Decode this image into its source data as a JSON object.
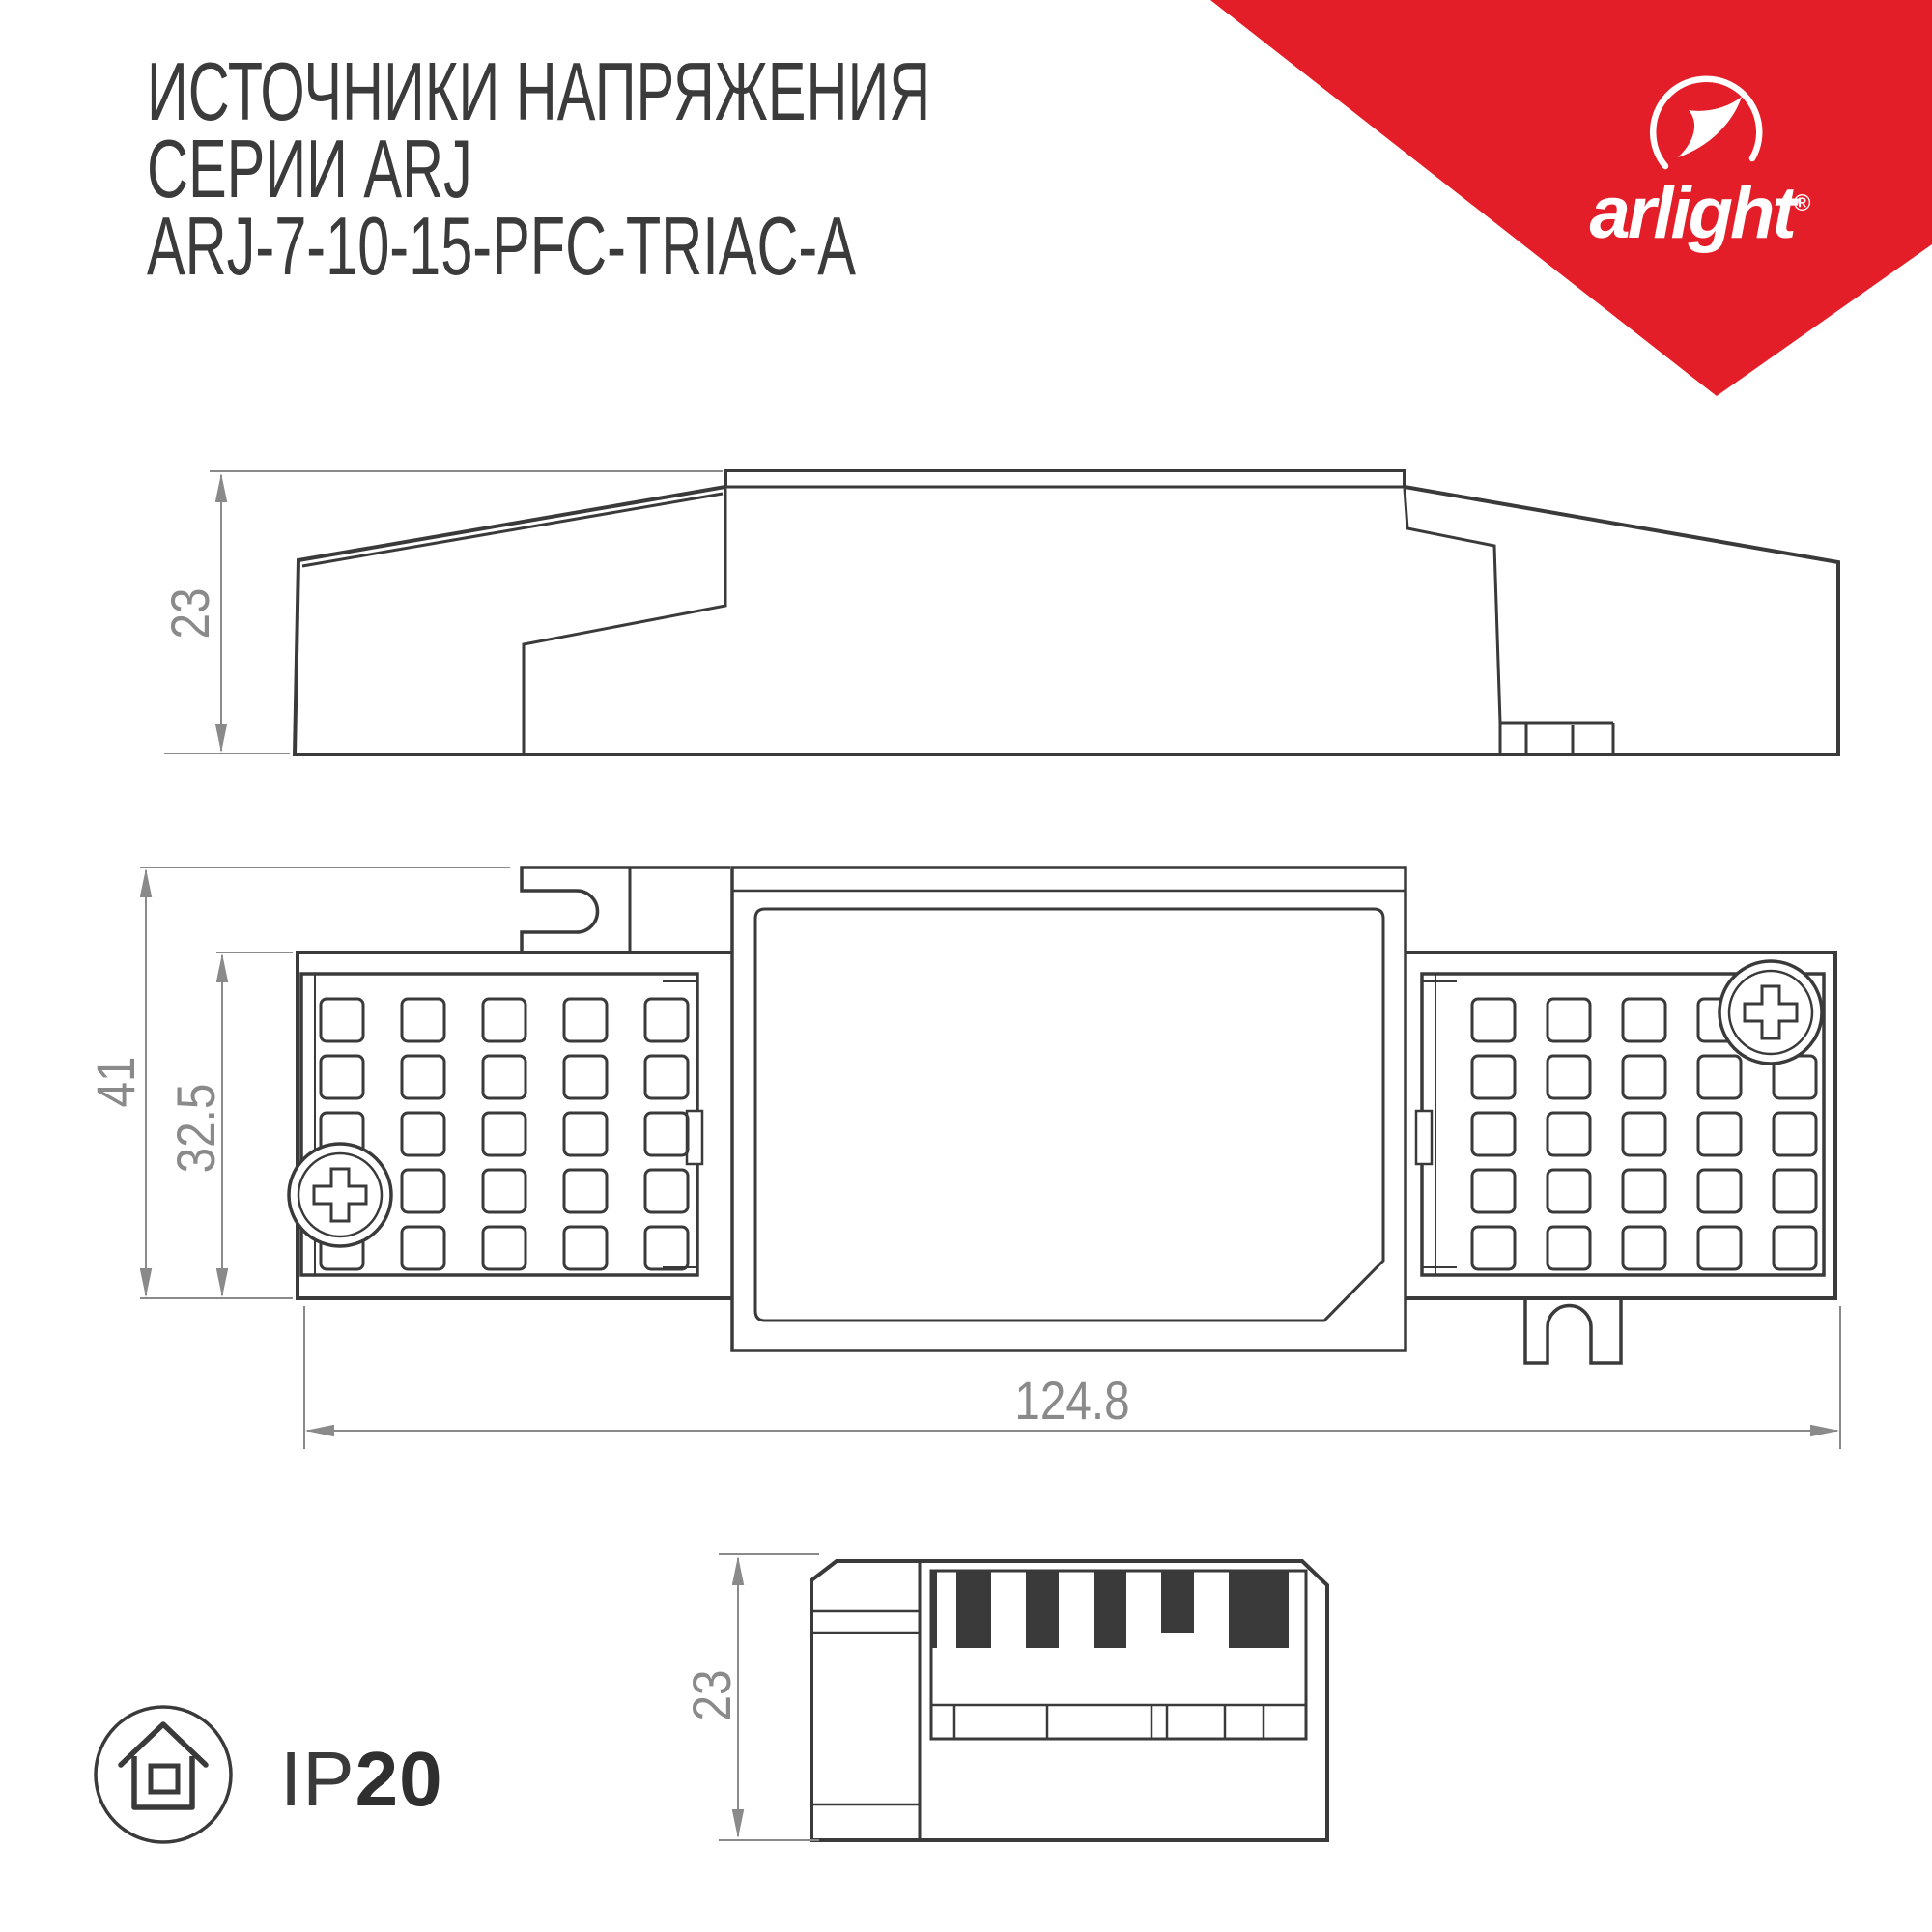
{
  "title": {
    "line1": "ИСТОЧНИКИ НАПРЯЖЕНИЯ",
    "line2": "СЕРИИ ARJ",
    "line3": "ARJ-7-10-15-PFC-TRIAC-A"
  },
  "brand": {
    "name": "arlight",
    "registered": "®",
    "banner_color": "#e31e29"
  },
  "dimensions": {
    "side_view_height": "23",
    "top_view_overall": "41",
    "top_view_body": "32.5",
    "top_view_length": "124.8",
    "end_view_height": "23"
  },
  "ip_rating": {
    "prefix": "IP",
    "value": "20"
  },
  "colors": {
    "line_art": "#3a3a3a",
    "dimension_gray": "#8a8a8a",
    "title_text": "#3b3b3b",
    "brand_red": "#e31e29"
  }
}
